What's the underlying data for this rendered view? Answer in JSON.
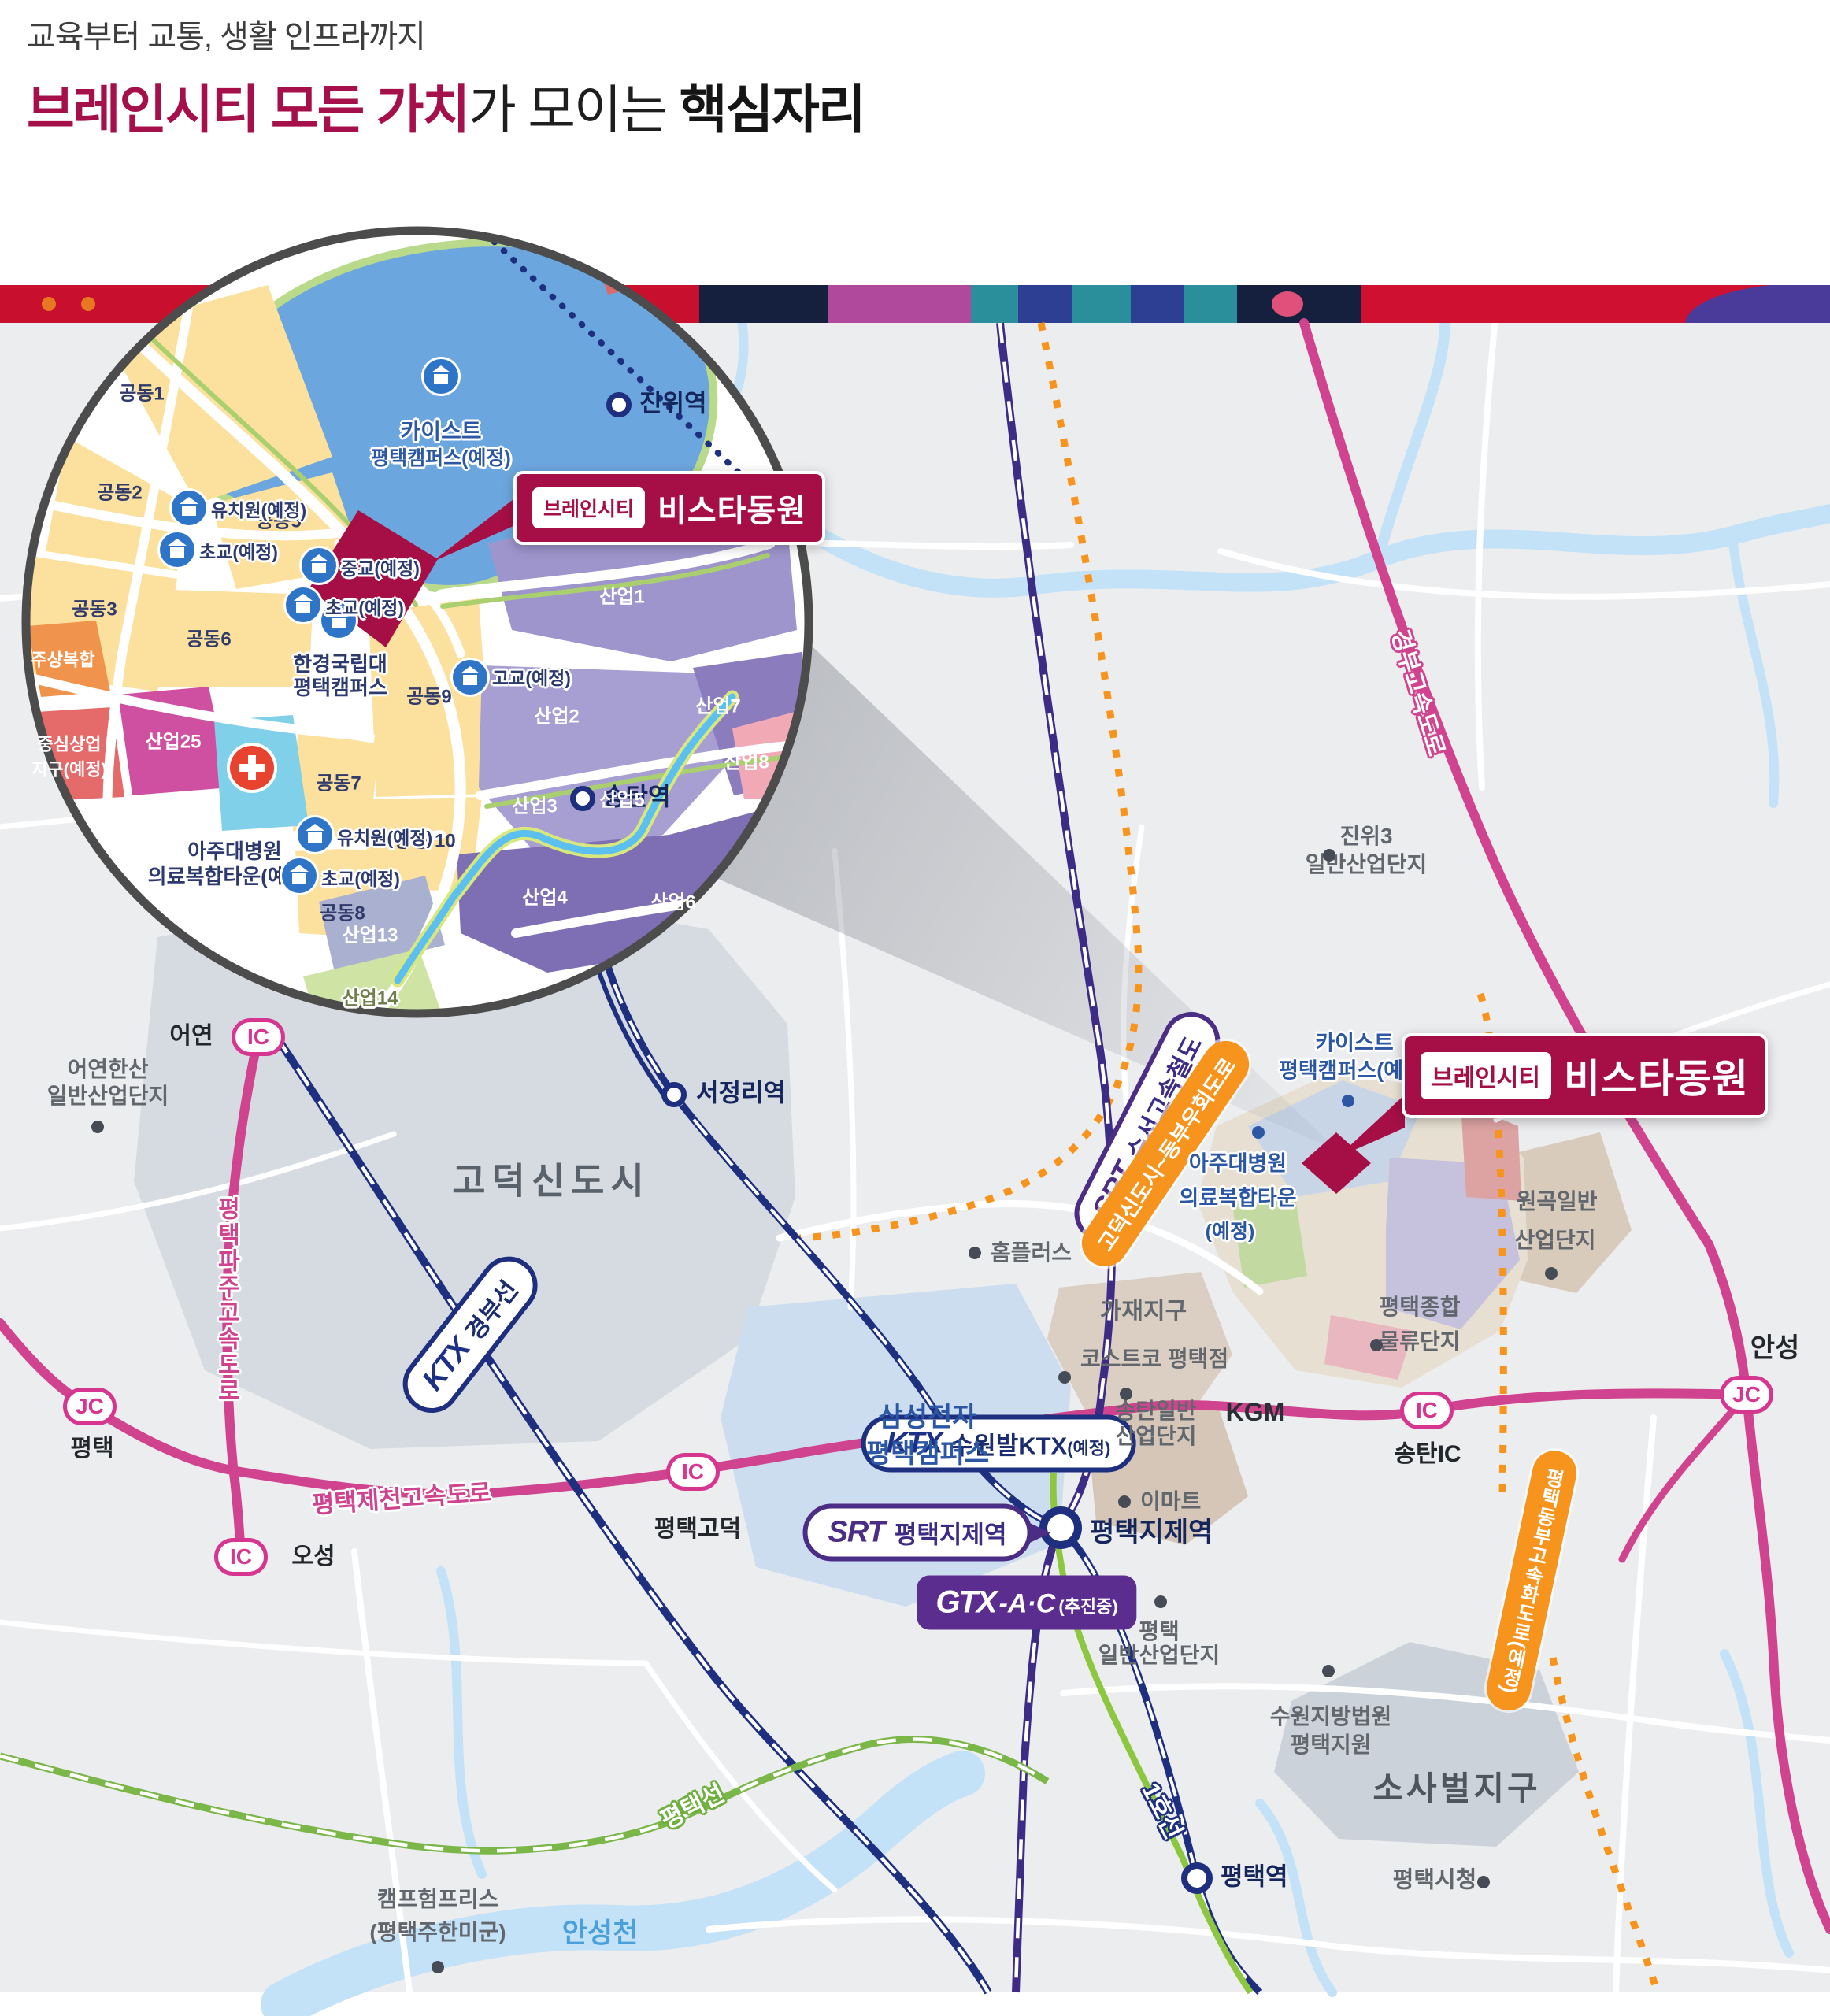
{
  "header": {
    "subtitle": "교육부터 교통, 생활 인프라까지",
    "title_accent": "브레인시티 모든 가치",
    "title_mid": "가 모이는 ",
    "title_strong": "핵심자리"
  },
  "brand": {
    "tag": "브레인시티",
    "name": "비스타동원"
  },
  "colors": {
    "accent": "#a50f45",
    "pink_road": "#d0438f",
    "orange": "#f7941e",
    "purple": "#4b2d85",
    "navy": "#1d2f7e",
    "green": "#7ab648",
    "gtx_purple": "#5b2d8e",
    "strip": [
      "#c8102e",
      "#15203f",
      "#b0499c",
      "#2a8f9b",
      "#2c3f92",
      "#d01030",
      "#4a3b9a",
      "#e0507a"
    ]
  },
  "transit": {
    "srt_suseo": {
      "logo": "SRT",
      "label": "수서고속철도"
    },
    "ktx_gyeongbu": {
      "logo": "KTX",
      "label": "경부선"
    },
    "ktx_suwon": {
      "logo": "KTX",
      "label": "수원발KTX",
      "suffix": "(예정)"
    },
    "srt_jije": {
      "logo": "SRT",
      "label": "평택지제역"
    },
    "gtx": {
      "logo": "GTX",
      "line": "-A·C",
      "suffix": "(추진중)"
    },
    "line1": "1호선",
    "pt_line": "평택선"
  },
  "roads": {
    "ptpaju": "평택파주고속도로",
    "ptjecheon": "평택제천고속도로",
    "gyeongbu": "경부고속도로",
    "ptdongbu": "평택동부고속화도로(예정)",
    "godeok_bypass": "고덕신도시~동부우회도로"
  },
  "stations": {
    "jinwi": "진위역",
    "songtan": "송탄역",
    "seojeongri": "서정리역",
    "jije": "평택지제역",
    "pyeongtaek": "평택역"
  },
  "ic": {
    "badge_ic": "IC",
    "badge_jc": "JC",
    "eoyeon": "어연",
    "oseong": "오성",
    "godeok": "평택고덕",
    "songtan": "송탄IC",
    "pt": "평택",
    "anseong": "안성"
  },
  "districts": {
    "godeok_nt": "고덕신도시",
    "samsung": [
      "삼성전자",
      "평택캠퍼스"
    ],
    "kaist": [
      "카이스트",
      "평택캠퍼스(예정)"
    ],
    "ajou": [
      "아주대병원",
      "의료복합타운",
      "(예정)"
    ],
    "jinwi3": [
      "진위3",
      "일반산업단지"
    ],
    "eoyeonhansan": [
      "어연한산",
      "일반산업단지"
    ],
    "gajae": "가재지구",
    "homeplus": "홈플러스",
    "costco": "코스트코 평택점",
    "songtan_ind": [
      "송탄일반",
      "산업단지"
    ],
    "wongok": [
      "원곡일반",
      "산업단지"
    ],
    "logistics": [
      "평택종합",
      "물류단지"
    ],
    "kgm": "KGM",
    "emart": "이마트",
    "pt_ind": [
      "평택",
      "일반산업단지"
    ],
    "court": [
      "수원지방법원",
      "평택지원"
    ],
    "sosabeol": "소사벌지구",
    "cityhall": "평택시청",
    "camp": [
      "캠프험프리스",
      "(평택주한미군)"
    ],
    "anseongcheon": "안성천"
  },
  "inset": {
    "kaist": [
      "카이스트",
      "평택캠퍼스(예정)"
    ],
    "hankyong": [
      "한경국립대",
      "평택캠퍼스"
    ],
    "ajou": [
      "아주대병원",
      "의료복합타운(예정)"
    ],
    "schools": {
      "kinder": "유치원(예정)",
      "elem": "초교(예정)",
      "middle": "중교(예정)",
      "high": "고교(예정)"
    },
    "blocks": {
      "g1": "공동1",
      "g2": "공동2",
      "g3": "공동3",
      "g5": "공동5",
      "g6": "공동6",
      "g7": "공동7",
      "g8": "공동8",
      "g9": "공동9",
      "g10": "공동 10",
      "s1": "산업1",
      "s2": "산업2",
      "s3": "산업3",
      "s4": "산업4",
      "s5": "산업5",
      "s6": "산업6",
      "s7": "산업7",
      "s8": "산업8",
      "s13": "산업13",
      "s14": "산업14",
      "s25": "산업25",
      "jusang": "주상복합",
      "commercial": [
        "중심상업",
        "지구(예정)"
      ]
    }
  }
}
